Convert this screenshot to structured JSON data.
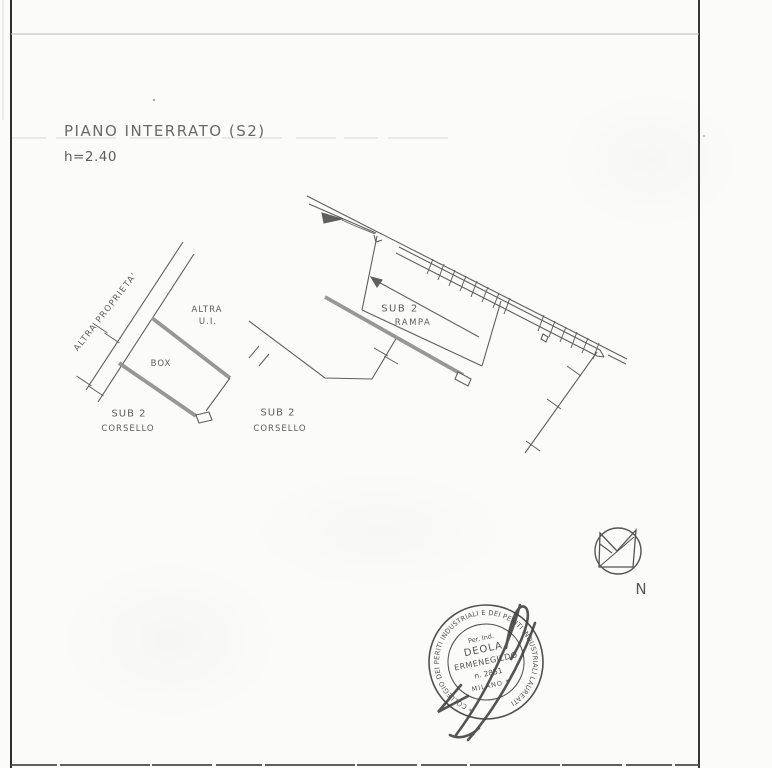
{
  "page": {
    "title": "PIANO INTERRATO (S2)",
    "height_note": "h=2.40"
  },
  "plan": {
    "labels": {
      "altra_proprieta": "ALTRA PROPRIETA'",
      "altra_ui_1": "ALTRA",
      "altra_ui_2": "U.I.",
      "box": "BOX",
      "sub2_left_1": "SUB 2",
      "sub2_left_2": "CORSELLO",
      "sub2_right_1": "SUB 2",
      "sub2_right_2": "CORSELLO",
      "rampa_1": "SUB 2",
      "rampa_2": "RAMPA"
    }
  },
  "compass": {
    "label": "N"
  },
  "stamp": {
    "ring_text": "* COLLEGIO DEI PERITI INDUSTRIALI E DEI PERITI INDUSTRIALI LAUREATI",
    "line1": "Per. Ind.",
    "line2": "DEOLA",
    "line3": "ERMENEGILDO",
    "line4": "n. 2851",
    "line5": "MILANO *"
  },
  "colors": {
    "paper": "#fbfbf9",
    "ink": "#5f5f5f",
    "frame": "#333333",
    "stamp_ink": "#434343"
  }
}
